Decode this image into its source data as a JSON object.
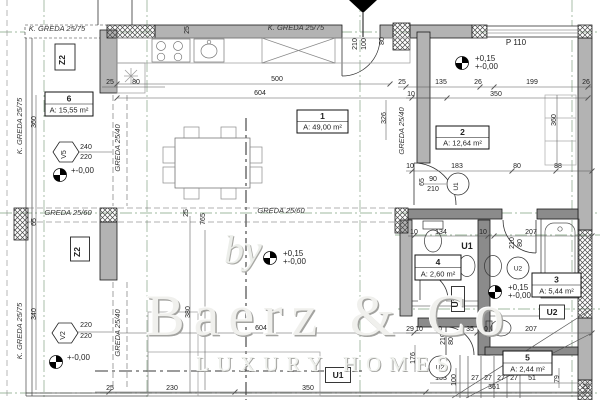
{
  "watermark": {
    "by": "by",
    "brand": "Baerz & Co",
    "tagline": "LUXURY HOMES"
  },
  "plan": {
    "rooms": [
      {
        "number": "6",
        "area": "A: 15,55 m²",
        "x": 45,
        "y": 92,
        "w": 48,
        "h": 24
      },
      {
        "number": "1",
        "area": "A: 49,00 m²",
        "x": 297,
        "y": 110,
        "w": 51,
        "h": 23
      },
      {
        "number": "2",
        "area": "A: 12,64 m²",
        "x": 436,
        "y": 126,
        "w": 53,
        "h": 23
      },
      {
        "number": "4",
        "area": "A: 2,60 m²",
        "x": 415,
        "y": 255,
        "w": 46,
        "h": 25
      },
      {
        "number": "3",
        "area": "A: 5,44 m²",
        "x": 532,
        "y": 273,
        "w": 49,
        "h": 24
      },
      {
        "number": "5",
        "area": "A: 2,44 m²",
        "x": 503,
        "y": 351,
        "w": 49,
        "h": 24
      }
    ],
    "beams": [
      {
        "t": "K. GREDA 25/75",
        "x": 57,
        "y": 31,
        "r": 0
      },
      {
        "t": "K. GREDA 25/75",
        "x": 296,
        "y": 30,
        "r": 0
      },
      {
        "t": "K. GREDA 25/75",
        "x": 22,
        "y": 126,
        "r": -90
      },
      {
        "t": "K. GREDA 25/75",
        "x": 22,
        "y": 331,
        "r": -90
      },
      {
        "t": "GREDA 25/40",
        "x": 120,
        "y": 148,
        "r": -90
      },
      {
        "t": "GREDA 25/40",
        "x": 120,
        "y": 333,
        "r": -90
      },
      {
        "t": "GREDA 25/40",
        "x": 404,
        "y": 131,
        "r": -90
      },
      {
        "t": "GREDA 25/60",
        "x": 68,
        "y": 215,
        "r": 0
      },
      {
        "t": "GREDA 25/60",
        "x": 281,
        "y": 213,
        "r": 0
      }
    ],
    "dims": [
      {
        "t": "25",
        "x": 189,
        "y": 30,
        "r": -90
      },
      {
        "t": "210",
        "x": 357,
        "y": 44,
        "r": -90
      },
      {
        "t": "100",
        "x": 366,
        "y": 44,
        "r": -90
      },
      {
        "t": "80",
        "x": 384,
        "y": 41,
        "r": -90
      },
      {
        "t": "500",
        "x": 277,
        "y": 81,
        "r": 0
      },
      {
        "t": "604",
        "x": 260,
        "y": 95,
        "r": 0
      },
      {
        "t": "25",
        "x": 110,
        "y": 84,
        "r": 0
      },
      {
        "t": "80",
        "x": 136,
        "y": 84,
        "r": 0
      },
      {
        "t": "P 110",
        "x": 516,
        "y": 45,
        "r": 0,
        "s": 8
      },
      {
        "t": "25",
        "x": 402,
        "y": 84,
        "r": 0
      },
      {
        "t": "135",
        "x": 441,
        "y": 84,
        "r": 0
      },
      {
        "t": "26",
        "x": 478,
        "y": 84,
        "r": 0
      },
      {
        "t": "199",
        "x": 532,
        "y": 84,
        "r": 0
      },
      {
        "t": "26",
        "x": 586,
        "y": 84,
        "r": 0
      },
      {
        "t": "10",
        "x": 411,
        "y": 96,
        "r": 0
      },
      {
        "t": "350",
        "x": 496,
        "y": 96,
        "r": 0
      },
      {
        "t": "360",
        "x": 36,
        "y": 122,
        "r": -90
      },
      {
        "t": "326",
        "x": 386,
        "y": 118,
        "r": -90
      },
      {
        "t": "360",
        "x": 556,
        "y": 120,
        "r": -90
      },
      {
        "t": "240",
        "x": 86,
        "y": 149,
        "r": 0
      },
      {
        "t": "220",
        "x": 86,
        "y": 159,
        "r": 0
      },
      {
        "t": "10",
        "x": 410,
        "y": 168,
        "r": 0
      },
      {
        "t": "183",
        "x": 457,
        "y": 168,
        "r": 0
      },
      {
        "t": "80",
        "x": 517,
        "y": 168,
        "r": 0
      },
      {
        "t": "88",
        "x": 558,
        "y": 168,
        "r": 0
      },
      {
        "t": "65",
        "x": 424,
        "y": 182,
        "r": -90
      },
      {
        "t": "90",
        "x": 433,
        "y": 181,
        "r": 0
      },
      {
        "t": "210",
        "x": 433,
        "y": 191,
        "r": 0
      },
      {
        "t": "25",
        "x": 188,
        "y": 213,
        "r": -90
      },
      {
        "t": "765",
        "x": 205,
        "y": 219,
        "r": -90
      },
      {
        "t": "65",
        "x": 36,
        "y": 222,
        "r": -90
      },
      {
        "t": "10",
        "x": 414,
        "y": 234,
        "r": 0
      },
      {
        "t": "134",
        "x": 441,
        "y": 234,
        "r": 0
      },
      {
        "t": "10",
        "x": 483,
        "y": 234,
        "r": 0
      },
      {
        "t": "207",
        "x": 531,
        "y": 234,
        "r": 0
      },
      {
        "t": "210",
        "x": 514,
        "y": 243,
        "r": -90
      },
      {
        "t": "80",
        "x": 522,
        "y": 243,
        "r": -90
      },
      {
        "t": "340",
        "x": 36,
        "y": 314,
        "r": -90
      },
      {
        "t": "380",
        "x": 190,
        "y": 312,
        "r": -90
      },
      {
        "t": "604",
        "x": 261,
        "y": 330,
        "r": 0
      },
      {
        "t": "220",
        "x": 86,
        "y": 327,
        "r": 0
      },
      {
        "t": "220",
        "x": 86,
        "y": 338,
        "r": 0
      },
      {
        "t": "29",
        "x": 410,
        "y": 331,
        "r": 0
      },
      {
        "t": "10",
        "x": 419,
        "y": 331,
        "r": 0
      },
      {
        "t": "80",
        "x": 438,
        "y": 331,
        "r": 0
      },
      {
        "t": "35",
        "x": 470,
        "y": 331,
        "r": 0
      },
      {
        "t": "10",
        "x": 484,
        "y": 331,
        "r": 0
      },
      {
        "t": "207",
        "x": 531,
        "y": 331,
        "r": 0
      },
      {
        "t": "210",
        "x": 445,
        "y": 339,
        "r": -90
      },
      {
        "t": "80",
        "x": 453,
        "y": 341,
        "r": -90
      },
      {
        "t": "176",
        "x": 415,
        "y": 358,
        "r": -90
      },
      {
        "t": "133",
        "x": 441,
        "y": 380,
        "r": 0
      },
      {
        "t": "100",
        "x": 456,
        "y": 380,
        "r": -90
      },
      {
        "t": "27",
        "x": 475,
        "y": 380,
        "r": 0
      },
      {
        "t": "27",
        "x": 488,
        "y": 380,
        "r": 0
      },
      {
        "t": "27",
        "x": 501,
        "y": 380,
        "r": 0
      },
      {
        "t": "27",
        "x": 514,
        "y": 380,
        "r": 0
      },
      {
        "t": "51",
        "x": 532,
        "y": 380,
        "r": 0
      },
      {
        "t": "79",
        "x": 559,
        "y": 379,
        "r": -90
      },
      {
        "t": "25",
        "x": 110,
        "y": 390,
        "r": 0
      },
      {
        "t": "230",
        "x": 172,
        "y": 390,
        "r": 0
      },
      {
        "t": "350",
        "x": 308,
        "y": 390,
        "r": 0
      },
      {
        "t": "361",
        "x": 494,
        "y": 389,
        "r": 0
      },
      {
        "t": "25",
        "x": 586,
        "y": 389,
        "r": 0
      }
    ],
    "markers": {
      "hexagons": [
        {
          "t": "V5",
          "cx": 66,
          "cy": 152
        },
        {
          "t": "V2",
          "cx": 65,
          "cy": 333
        }
      ],
      "boxes": [
        {
          "t": "Z2",
          "cx": 65,
          "cy": 57,
          "w": 20,
          "h": 26,
          "r": -90
        },
        {
          "t": "Z2",
          "cx": 80,
          "cy": 249,
          "w": 19,
          "h": 24,
          "r": -90
        },
        {
          "t": "U1",
          "cx": 338,
          "cy": 375,
          "w": 25,
          "h": 15,
          "r": 0
        },
        {
          "t": "U2",
          "cx": 552,
          "cy": 312,
          "w": 25,
          "h": 14,
          "r": 0
        },
        {
          "t": "U2",
          "cx": 458,
          "cy": 299,
          "w": 13,
          "h": 25,
          "r": -90
        }
      ],
      "circles": [
        {
          "t": "U1",
          "cx": 458,
          "cy": 184,
          "r": -90
        },
        {
          "t": "U2",
          "cx": 518,
          "cy": 268,
          "r": 0
        },
        {
          "t": "U2",
          "cx": 440,
          "cy": 367,
          "r": 0
        }
      ],
      "plain": [
        {
          "t": "U1",
          "x": 467,
          "y": 249
        }
      ]
    },
    "elevations": [
      {
        "t1": "",
        "t2": "+-0,00",
        "cx": 60,
        "cy": 175
      },
      {
        "t1": "",
        "t2": "+-0,00",
        "cx": 56,
        "cy": 362
      },
      {
        "t1": "+0,15",
        "t2": "+-0,00",
        "cx": 270,
        "cy": 258
      },
      {
        "t1": "+0,15",
        "t2": "+-0,00",
        "cx": 462,
        "cy": 63
      },
      {
        "t1": "+0,15",
        "t2": "+-0,00",
        "cx": 495,
        "cy": 292
      }
    ]
  }
}
